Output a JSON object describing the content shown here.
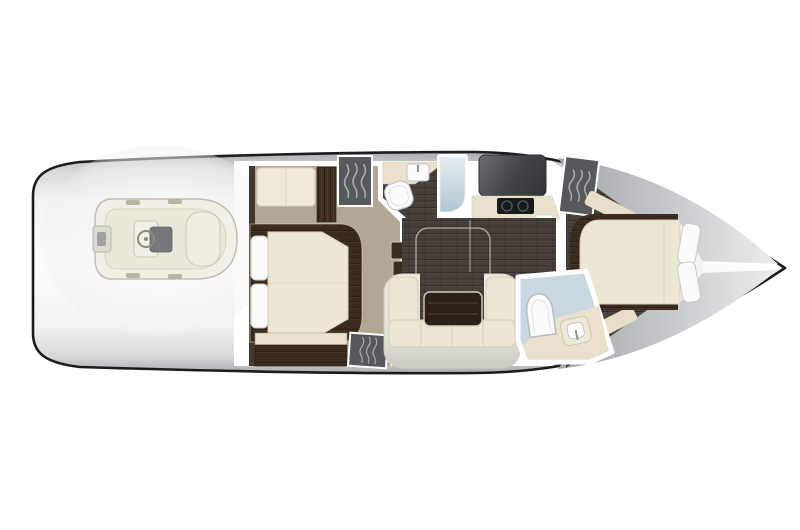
{
  "meta": {
    "title": "Yacht lower-deck interior floor plan (top view)",
    "figure_type": "boat-floorplan",
    "orientation": "bow-right-stern-left"
  },
  "palette": {
    "background": "#ffffff",
    "hull_outline": "#1c1c1c",
    "deck_light": "#f6f7f7",
    "deck_shade": "#aab0b4",
    "wall_white": "#ffffff",
    "carpet": "#b1a794",
    "salon_wood": "#473f3a",
    "wood_brown": "#3b2b1e",
    "cream": "#ece6d4",
    "cream_dark": "#e7dfca",
    "counter_beige": "#e9e1cb",
    "locker_gray": "#55595d",
    "locker_wave": "#b9bdc0",
    "shower_blue": "#c9d7e0",
    "appliance_black": "#17191b",
    "fixture_white": "#fbfbfa",
    "tender_body": "#f2f0e6",
    "sofa_edge": "#c9cac4"
  },
  "stern": {
    "platform_label": "Swim platform",
    "tender": {
      "label": "Tender dinghy stowed on platform",
      "parts": [
        "inflatable tube",
        "outboard engine",
        "helm console",
        "steering wheel",
        "helm seat",
        "bow seat",
        "tube pads"
      ]
    }
  },
  "rooms": [
    {
      "id": "aft-stateroom",
      "label": "Aft stateroom",
      "fixtures": [
        "double berth",
        "two pillows",
        "settee",
        "wardrobe cabinet",
        "hanging locker",
        "dresser cabinet",
        "entry steps"
      ]
    },
    {
      "id": "mid-head",
      "label": "Mid head with shower",
      "fixtures": [
        "toilet",
        "vanity counter",
        "sink",
        "shower stall"
      ]
    },
    {
      "id": "galley",
      "label": "Galley",
      "fixtures": [
        "dark countertop",
        "two-burner cooktop",
        "counter",
        "refrigerator cabinet"
      ]
    },
    {
      "id": "salon",
      "label": "Salon",
      "fixtures": [
        "wood flooring",
        "hi-lo table",
        "u-shaped sofa",
        "table footprint outline"
      ]
    },
    {
      "id": "guest-head",
      "label": "Guest head with shower",
      "fixtures": [
        "toilet",
        "sink counter",
        "shower glass"
      ]
    },
    {
      "id": "bow-stateroom",
      "label": "Forward stateroom",
      "fixtures": [
        "island berth",
        "two pillows",
        "hanging locker",
        "side shelf",
        "side bench"
      ]
    }
  ]
}
